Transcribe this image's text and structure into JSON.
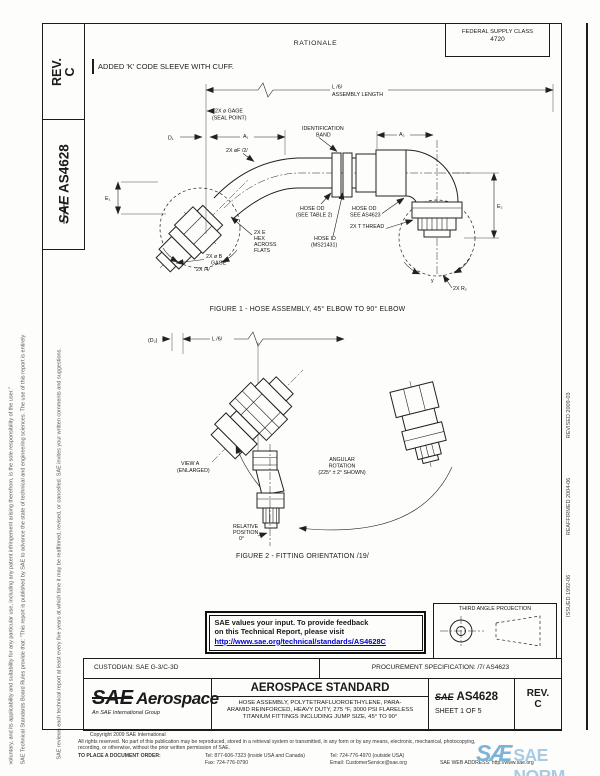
{
  "header": {
    "rev_label": "REV.",
    "rev_value": "C",
    "doc_sae": "SAE",
    "doc_number": "AS4628",
    "federal_supply_class_label": "FEDERAL SUPPLY CLASS",
    "federal_supply_class_value": "4720",
    "rationale_title": "RATIONALE",
    "change_note": "ADDED 'K' CODE SLEEVE WITH CUFF."
  },
  "margins": {
    "left_line1": "SAE Technical Standards Board Rules provide that: \"This report is published by SAE to advance the state of technical and engineering sciences. The use of this report is entirely",
    "left_line2": "voluntary, and its applicability and suitability for any particular use, including any patent infringement arising therefrom, is the sole responsibility of the user.\"",
    "left_line3": "SAE reviews each technical report at least every five years at which time it may be reaffirmed, revised, or cancelled. SAE invites your written comments and suggestions.",
    "issued": "ISSUED 1992-06",
    "reaffirmed": "REAFFIRMED 2004-06",
    "revised": "REVISED 2009-03"
  },
  "fig1": {
    "caption": "FIGURE 1 - HOSE ASSEMBLY, 45° ELBOW TO 90° ELBOW",
    "labels": {
      "len1": "L /6/",
      "len2": "ASSEMBLY LENGTH",
      "gage1": "2X ø GAGE",
      "gage2": "(SEAL POINT)",
      "d1": "D₁",
      "a1": "A₁",
      "a2": "A₂",
      "e1": "E₁",
      "e2": "E₂",
      "f": "2X øF /2/",
      "band1": "IDENTIFICATION",
      "band2": "BAND",
      "hose_od1": "HOSE OD",
      "hose_od2": "(SEE TABLE 2)",
      "hose_id1": "HOSE ID",
      "hose_id2": "(MS21431)",
      "od_ref1": "HOSE OD",
      "od_ref2": "SEE AS4623",
      "thread": "2X T THREAD",
      "hex1": "2X E",
      "hex2": "HEX",
      "hex3": "ACROSS",
      "hex4": "FLATS",
      "bgage1": "2X ø B",
      "bgage2": "GAGE",
      "note4": "2X /4/",
      "r2": "2X R₂",
      "rot": "y"
    }
  },
  "fig2": {
    "caption": "FIGURE 2 - FITTING ORIENTATION /19/",
    "labels": {
      "d2": "(D₂)",
      "len": "L /6/",
      "view1": "VIEW A",
      "view2": "(ENLARGED)",
      "ang1": "ANGULAR",
      "ang2": "ROTATION",
      "ang3": "(225° ± 2° SHOWN)",
      "rel1": "RELATIVE",
      "rel2": "POSITION",
      "rel3": "0°"
    }
  },
  "feedback": {
    "line1": "SAE values your input. To provide feedback",
    "line2": "on this Technical Report, please visit",
    "url": "http://www.sae.org/technical/standards/AS4628C"
  },
  "projection": {
    "title": "THIRD ANGLE PROJECTION"
  },
  "block": {
    "custodian": "CUSTODIAN: SAE G-3/C-3D",
    "procurement": "PROCUREMENT SPECIFICATION: /7/ AS4623",
    "logo_sae": "SAE",
    "logo_aero": "Aerospace",
    "logo_tag": "An SAE International Group",
    "standard": "AEROSPACE STANDARD",
    "title1": "HOSE ASSEMBLY, POLYTETRAFLUOROETHYLENE, PARA-",
    "title2": "ARAMID REINFORCED, HEAVY DUTY, 275 °F, 3000 PSI FLARELESS",
    "title3": "TITANIUM FITTINGS INCLUDING JUMP SIZE, 45° TO 90°",
    "doc_sae": "SAE",
    "doc_number": "AS4628",
    "sheet": "SHEET 1 OF 5",
    "rev_label": "REV.",
    "rev_value": "C"
  },
  "footer": {
    "copyright": "Copyright 2009 SAE International",
    "rights1": "All rights reserved. No part of this publication may be reproduced, stored in a retrieval system or transmitted, in any form or by any means, electronic, mechanical, photocopying,",
    "rights2": "recording, or otherwise, without the prior written permission of SAE.",
    "order": "TO PLACE A DOCUMENT ORDER:",
    "tel1": "Tel: 877-606-7323 (inside USA and Canada)",
    "tel2": "Tel: 724-776-4970 (outside USA)",
    "fax": "Fax: 724-776-0790",
    "email": "Email: CustomerService@sae.org",
    "web": "SAE WEB ADDRESS: http://www.sae.org"
  },
  "watermark": {
    "logo": "SÆ",
    "title": "SAE NORM",
    "sub": "INTERNATIONAL"
  }
}
